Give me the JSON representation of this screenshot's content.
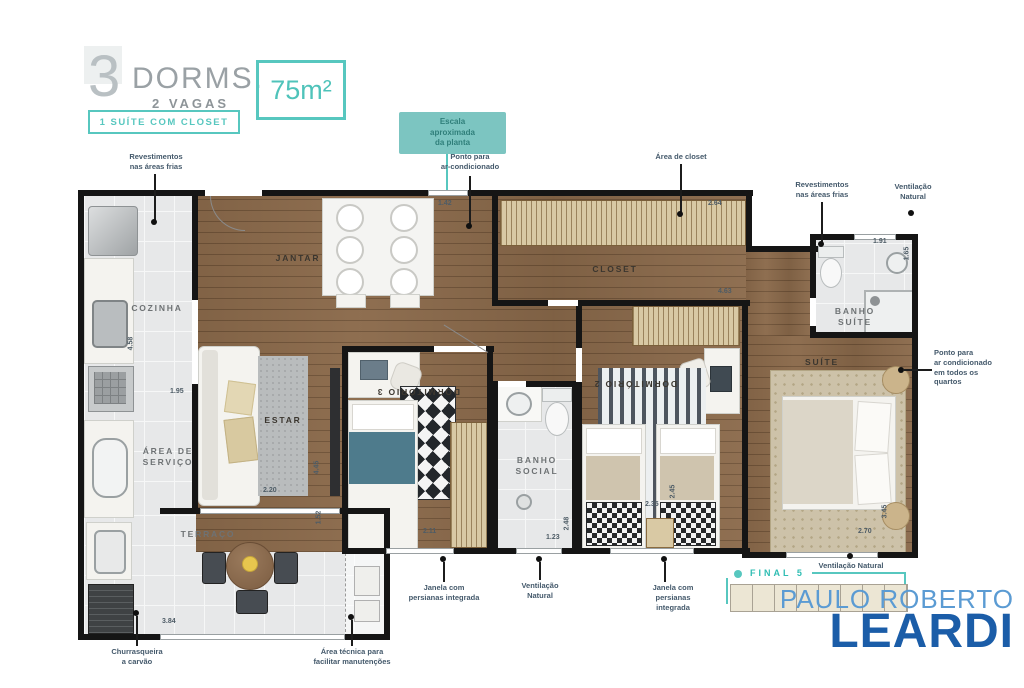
{
  "header": {
    "number": "3",
    "dorms": "DORMS.",
    "vagas": "2 VAGAS",
    "badge": "1 SUÍTE COM CLOSET",
    "area": "75m²"
  },
  "callout": "Escala\naproximada\nda planta",
  "rooms": {
    "cozinha": "COZINHA",
    "jantar": "JANTAR",
    "estar": "ESTAR",
    "servico": "ÁREA DE\nSERVIÇO",
    "terraco": "TERRAÇO",
    "dorm3": "DORMITÓRIO 3",
    "banho_social": "BANHO\nSOCIAL",
    "dorm2": "DORMITÓRIO 2",
    "closet": "CLOSET",
    "suite": "SUÍTE",
    "banho_suite": "BANHO\nSUÍTE"
  },
  "dims": {
    "d142": "1.42",
    "d264": "2.64",
    "d463": "4.63",
    "d191": "1.91",
    "d165": "1.65",
    "d458": "4.58",
    "d195": "1.95",
    "d220": "2.20",
    "d445": "4.45",
    "d211": "2.11",
    "d123": "1.23",
    "d248": "2.48",
    "d235": "2.35",
    "d245": "2.45",
    "d270": "2.70",
    "d345": "3.45",
    "d384": "3.84",
    "d152": "1.52"
  },
  "annotations": {
    "revest_left": "Revestimentos\nnas áreas frias",
    "ar_cond_top": "Ponto para\nar-condicionado",
    "area_closet": "Área de closet",
    "revest_right": "Revestimentos\nnas áreas frias",
    "vent_top": "Ventilação\nNatural",
    "ar_cond_quartos": "Ponto para\nar condicionado\nem todos os\nquartos",
    "janela_1": "Janela com\npersianas integrada",
    "vent_bottom": "Ventilação\nNatural",
    "janela_2": "Janela com\npersianas\nintegrada",
    "vent_suite": "Ventilação Natural",
    "churrasqueira": "Churrasqueira\na carvão",
    "area_tecnica": "Área técnica para\nfacilitar manutenções"
  },
  "branding": {
    "final": "FINAL 5",
    "name_top": "PAULO ROBERTO",
    "name_bottom": "LEARDI"
  },
  "colors": {
    "accent": "#57c7bf",
    "logo_light": "#5b9bd3",
    "logo_dark": "#1b5da8",
    "wood": "#8b6a4b",
    "tile": "#e7e8e9",
    "wall": "#151515"
  }
}
